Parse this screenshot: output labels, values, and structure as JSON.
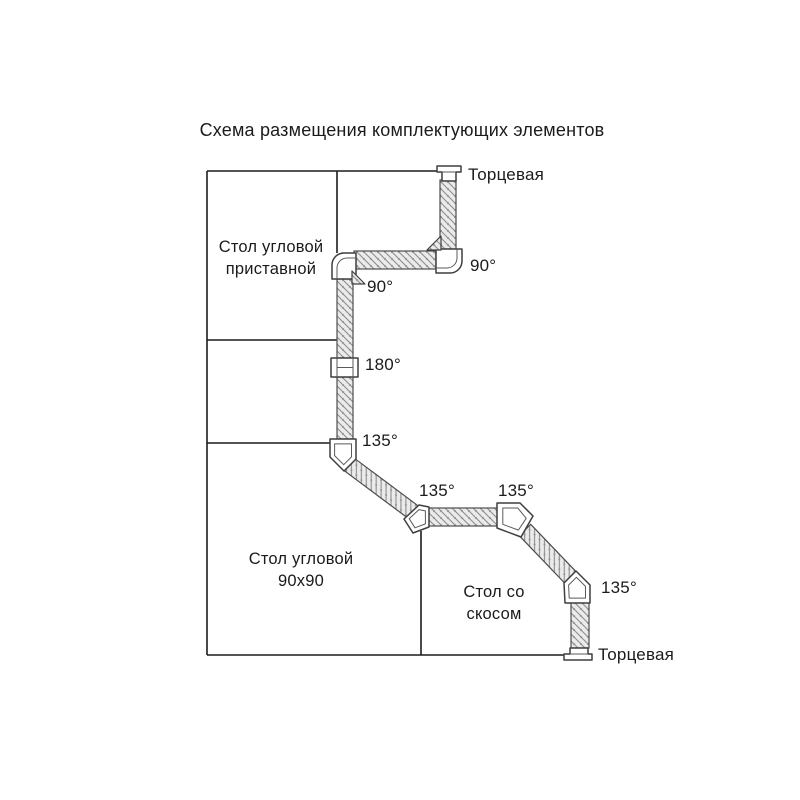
{
  "title": "Схема размещения комплектующих элементов",
  "tables": {
    "corner_attached": {
      "line1": "Стол угловой",
      "line2": "приставной"
    },
    "corner_90x90": {
      "line1": "Стол угловой",
      "line2": "90x90"
    },
    "beveled": {
      "line1": "Стол со",
      "line2": "скосом"
    }
  },
  "plinth": {
    "end_cap_top": "Торцевая",
    "end_cap_bottom": "Торцевая",
    "angles": {
      "a90_outer": "90°",
      "a90_inner": "90°",
      "a180": "180°",
      "a135_1": "135°",
      "a135_2": "135°",
      "a135_3": "135°",
      "a135_4": "135°"
    }
  },
  "colors": {
    "line": "#1c1c1c",
    "strip_outline": "#4d4d4d",
    "hatch_fill": "#ebebeb",
    "hatch_line": "#8d8d8d",
    "piece_fill": "#ffffff",
    "piece_stroke": "#3f3f3f",
    "text": "#1b1b1b"
  }
}
